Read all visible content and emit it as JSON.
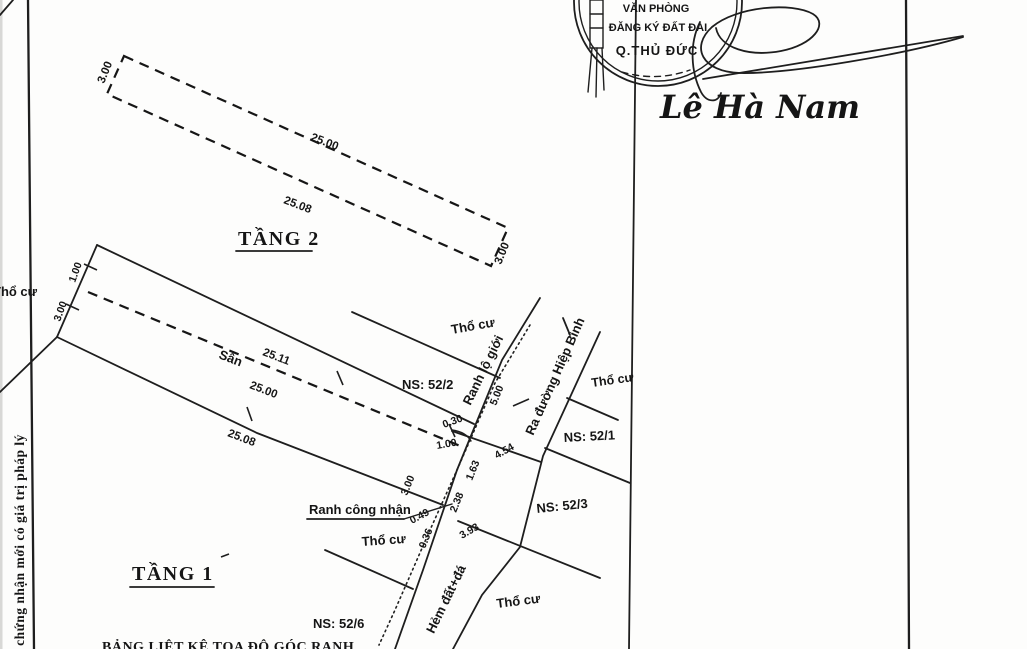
{
  "stamp": {
    "line1": "VĂN PHÒNG",
    "line2": "ĐĂNG KÝ ĐẤT ĐAI",
    "line3": "Q.THỦ ĐỨC"
  },
  "signature": {
    "name": "Lê Hà Nam"
  },
  "margin": {
    "side_note": "y chứng nhận mới có giá trị pháp lý",
    "bottom_caption": "BẢNG LIỆT KÊ TỌA ĐỘ GÓC RANH"
  },
  "floor2": {
    "title": "TẦNG 2",
    "dim_left": "3.00",
    "dim_top": "25.00",
    "dim_bottom": "25.08",
    "dim_right": "3.00"
  },
  "floor1": {
    "title": "TẦNG 1",
    "yard": "Sân",
    "dim_yard_top": "25.11",
    "dim_yard_mid": "25.00",
    "dim_lower": "25.08",
    "cap_dim_top": "1.00",
    "cap_dim_bottom": "3.00"
  },
  "junction": {
    "d030": "0.30",
    "d100": "1.00",
    "d163": "1.63",
    "d300": "3.00",
    "d238": "2.38",
    "d049": "0.49",
    "d036": "0.36"
  },
  "road": {
    "lo_gioi": "Ranh lộ giới",
    "cong_nhan": "Ranh công nhận",
    "street": "Ra đường Hiệp Bình",
    "alley": "Hẻm đất+đá",
    "d500": "5.00",
    "d454": "4.54",
    "d393": "3.93"
  },
  "parcels": {
    "tho_cu": "Thổ cư",
    "ns52_2": "NS: 52/2",
    "ns52_1": "NS: 52/1",
    "ns52_3": "NS: 52/3",
    "ns52_6": "NS: 52/6"
  }
}
